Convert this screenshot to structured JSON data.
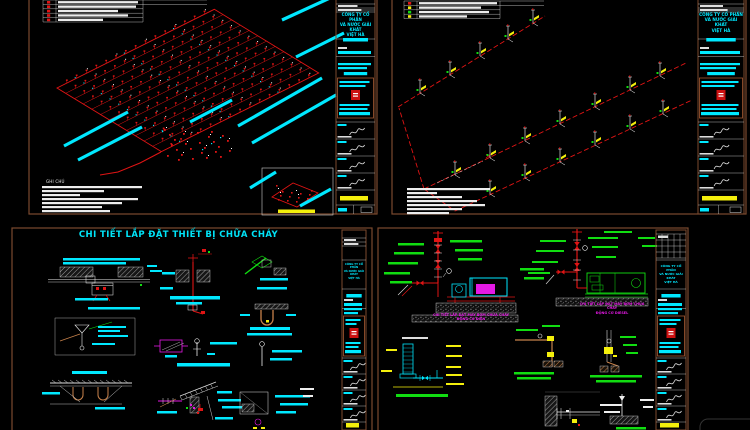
{
  "colors": {
    "background": "#000000",
    "sheet_border": "#7b4a2e",
    "cyan": "#00e8ff",
    "red": "#e01414",
    "yellow": "#f4ef0c",
    "green": "#11dd11",
    "magenta": "#e519e5",
    "white": "#ededed",
    "tan": "#c8824b",
    "hatch_gray": "#b0b0b0"
  },
  "texts": {
    "detail_title": "CHI TIẾT LẮP ĐẶT THIẾT BỊ CHỮA CHÁY",
    "notes_label": "GHI CHÚ",
    "company": {
      "line1": "CÔNG TY CỔ PHẦN",
      "line2": "VÀ NƯỚC GIẢI KHÁT",
      "line3": "VIỆT HÀ"
    },
    "captions": {
      "pump_electric_line1": "CHI TIẾT LẮP ĐẶT MÁY BƠM CHỮA CHÁY",
      "pump_electric_line2": "ĐỘNG CƠ ĐIỆN",
      "pump_diesel_line1": "CHI TIẾT LẮP ĐẶT MÁY BƠM CHỮA CHÁY",
      "pump_diesel_line2": "ĐỘNG CƠ DIESEL"
    }
  }
}
